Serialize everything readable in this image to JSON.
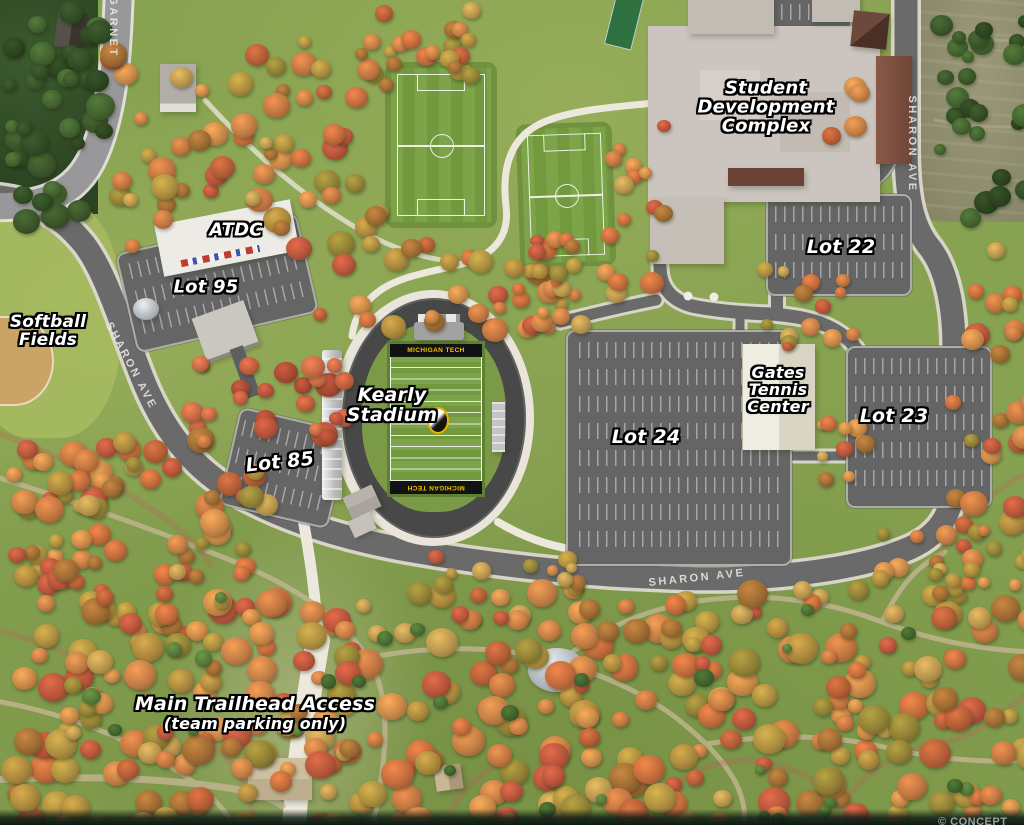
{
  "labels": [
    {
      "id": "student-development-complex",
      "text": "Student\nDevelopment\nComplex",
      "x": 766,
      "y": 108,
      "size": 18
    },
    {
      "id": "atdc",
      "text": "ATDC",
      "x": 236,
      "y": 231,
      "size": 18
    },
    {
      "id": "lot-95",
      "text": "Lot 95",
      "x": 206,
      "y": 288,
      "size": 18
    },
    {
      "id": "softball-fields",
      "text": "Softball\nFields",
      "x": 48,
      "y": 332,
      "size": 17
    },
    {
      "id": "kearly-stadium",
      "text": "Kearly\nStadium",
      "x": 392,
      "y": 406,
      "size": 19
    },
    {
      "id": "lot-85",
      "text": "Lot 85",
      "x": 280,
      "y": 463,
      "size": 19,
      "rotate": -6
    },
    {
      "id": "lot-24",
      "text": "Lot 24",
      "x": 646,
      "y": 438,
      "size": 19
    },
    {
      "id": "lot-22",
      "text": "Lot 22",
      "x": 841,
      "y": 248,
      "size": 19
    },
    {
      "id": "lot-23",
      "text": "Lot 23",
      "x": 894,
      "y": 417,
      "size": 19
    },
    {
      "id": "gates-tennis-center",
      "text": "Gates\nTennis\nCenter",
      "x": 778,
      "y": 390,
      "size": 16
    },
    {
      "id": "main-trailhead-access",
      "text": "Main Trailhead Access",
      "sub": "(team parking only)",
      "x": 255,
      "y": 714,
      "size": 19
    }
  ],
  "road_labels": [
    {
      "id": "garnet",
      "text": "GARNET",
      "x": 113,
      "y": 27,
      "rotate": 90
    },
    {
      "id": "sharon-ave-north",
      "text": "SHARON AVE",
      "x": 912,
      "y": 144,
      "rotate": 90
    },
    {
      "id": "sharon-ave-west",
      "text": "SHARON AVE",
      "x": 131,
      "y": 366,
      "rotate": 62
    },
    {
      "id": "sharon-ave-south",
      "text": "SHARON AVE",
      "x": 697,
      "y": 578,
      "rotate": -6
    }
  ],
  "stadium": {
    "endzone_text": "MICHIGAN TECH",
    "mascot": "husky-logo"
  },
  "attribution": {
    "text": "© CONCEPT"
  },
  "colors": {
    "endzone_gold": "#f2c100",
    "endzone_black": "#121212",
    "lawn_green": "#87a251",
    "road_gray": "#6a6a6a"
  }
}
